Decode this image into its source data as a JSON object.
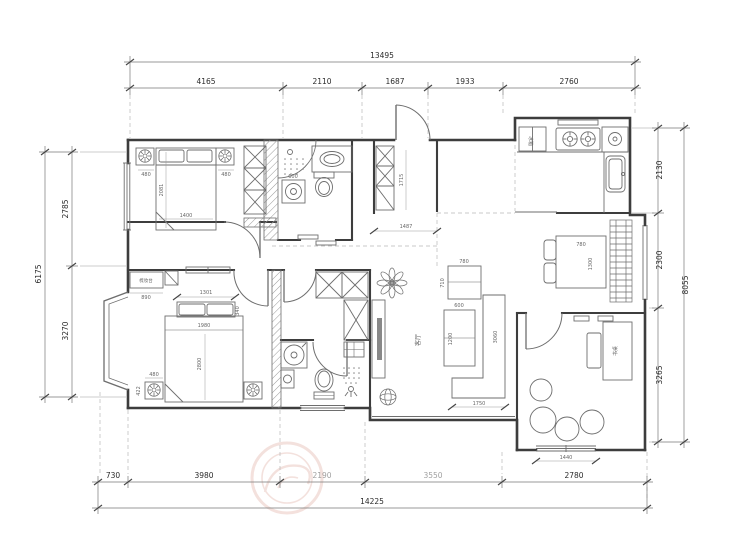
{
  "drawing": {
    "type": "apartment floor plan (CAD)",
    "compass_or_room_label": "客厅"
  },
  "palette": {
    "wall": "#3d3d3d",
    "furniture": "#6e6e6e",
    "dim_line": "#777777",
    "dim_text": "#2b2b2b",
    "dashed": "#b8b8b8",
    "watermark": "#e9c4bc"
  },
  "dimensions": {
    "top": {
      "total": "13495",
      "segments": [
        "4165",
        "2110",
        "1687",
        "1933",
        "2760"
      ]
    },
    "bottom": {
      "total": "14225",
      "segments": [
        "730",
        "3980",
        "2190",
        "3550",
        "2780"
      ]
    },
    "left": {
      "total": "6175",
      "segments": [
        "2785",
        "3270"
      ]
    },
    "right": {
      "total": "8055",
      "segments": [
        "2130",
        "2300",
        "3265"
      ]
    }
  },
  "furniture_dims": {
    "bedroom1": {
      "nightstand_left": "480",
      "nightstand_right": "480",
      "bed_length": "2081",
      "bed_width": "1400"
    },
    "bathroom1": {
      "washer": "600"
    },
    "entry": {
      "cabinet_depth": "1715",
      "width": "1487"
    },
    "living": {
      "side_table_w": "780",
      "side_table_d": "710",
      "sofa_w": "600",
      "sofa_l": "1200",
      "chaise_l": "3060",
      "chaise_w": "1750"
    },
    "master_bedroom": {
      "dresser": "890",
      "pillow_row": "1301",
      "pillow_depth": "340",
      "bed_width": "1980",
      "bed_length": "2800",
      "nightstand": "480",
      "nightstand_depth": "422"
    },
    "dining": {
      "table_w": "780",
      "table_l": "1300"
    },
    "leisure_room": {
      "window": "1440"
    }
  },
  "labels": {
    "living_room": "客厅",
    "dresser": "梳妆台",
    "fridge": "冰箱",
    "desk": "书桌"
  }
}
